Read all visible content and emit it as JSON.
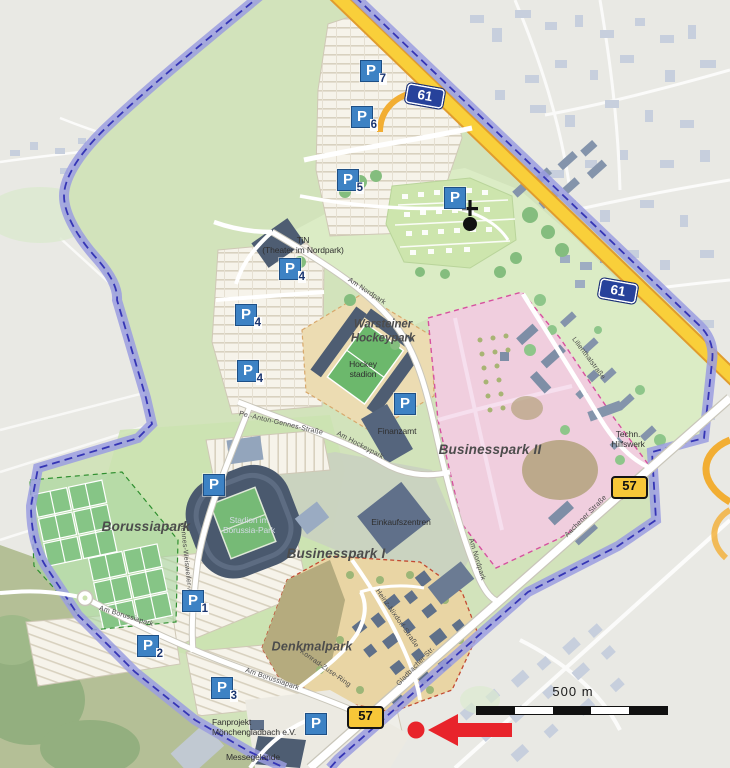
{
  "badges": {
    "autobahn": "61",
    "route": "57"
  },
  "parking": {
    "letter": "P",
    "numbers": [
      "7",
      "6",
      "5",
      "4",
      "4",
      "4",
      "1",
      "2",
      "3"
    ]
  },
  "areas": {
    "borussiapark": "Borussiapark",
    "businesspark1": "Businesspark I",
    "businesspark2": "Businesspark II",
    "denkmalpark": "Denkmalpark",
    "warsteiner_line1": "Warsteiner",
    "warsteiner_line2": "Hockeypark"
  },
  "places": {
    "tin_line1": "TiN",
    "tin_line2": "(Theater im Nordpark)",
    "hockey_line1": "Hockey",
    "hockey_line2": "stadion",
    "stadion_line1": "Stadion im",
    "stadion_line2": "Borussia-Park",
    "finanzamt": "Finanzamt",
    "einkaufszentrum": "Einkaufszentren",
    "thw_line1": "Techn.",
    "thw_line2": "Hilfswerk",
    "fanprojekt_line1": "Fanprojekt",
    "fanprojekt_line2": "Mönchengladbach e.V.",
    "messegelaende": "Messegelande"
  },
  "streets": {
    "am_nordpark": "Am Nordpark",
    "am_hockeypark": "Am Hockeypark",
    "hennes": "Hennes-Weisweiler-Allee",
    "am_borussiapark": "Am Borussiapark",
    "konrad_zuse": "Konrad-Zuse-Ring",
    "heinz_nixdorf": "Heinz-Nixdorf-Straße",
    "lilienthal": "Lilienthalstraße",
    "aachener": "Aachener Straße",
    "gladbacher": "Gladbacher Str.",
    "anton": "Pe.-Anton-Gennes-Straße"
  },
  "scale_label": "500 m",
  "colors": {
    "background_outside": "#e9e9e4",
    "park_green": "#d2e3bb",
    "forest_green": "#8ec68a",
    "parking_cream": "#f6f3ea",
    "businesspark_pink": "#f0cede",
    "denkmalpark_tan": "#e9d5a4",
    "building_slate": "#5a6a80",
    "building_gray_blue": "#c7cfdd",
    "stadium_slate": "#4a596e",
    "pitch_green": "#86c586",
    "boundary_purple": "#9b9de0",
    "boundary_dash_blue": "#3535b5",
    "highway_yellow": "#f9cf3a",
    "highway_casing": "#e09c2e",
    "road_white": "#ffffff",
    "autobahn_badge_blue": "#27429b",
    "route_badge_yellow": "#f7c738",
    "parking_badge_blue": "#3d82c4",
    "annotation_red": "#e8242b",
    "scalebar_black": "#111111"
  }
}
